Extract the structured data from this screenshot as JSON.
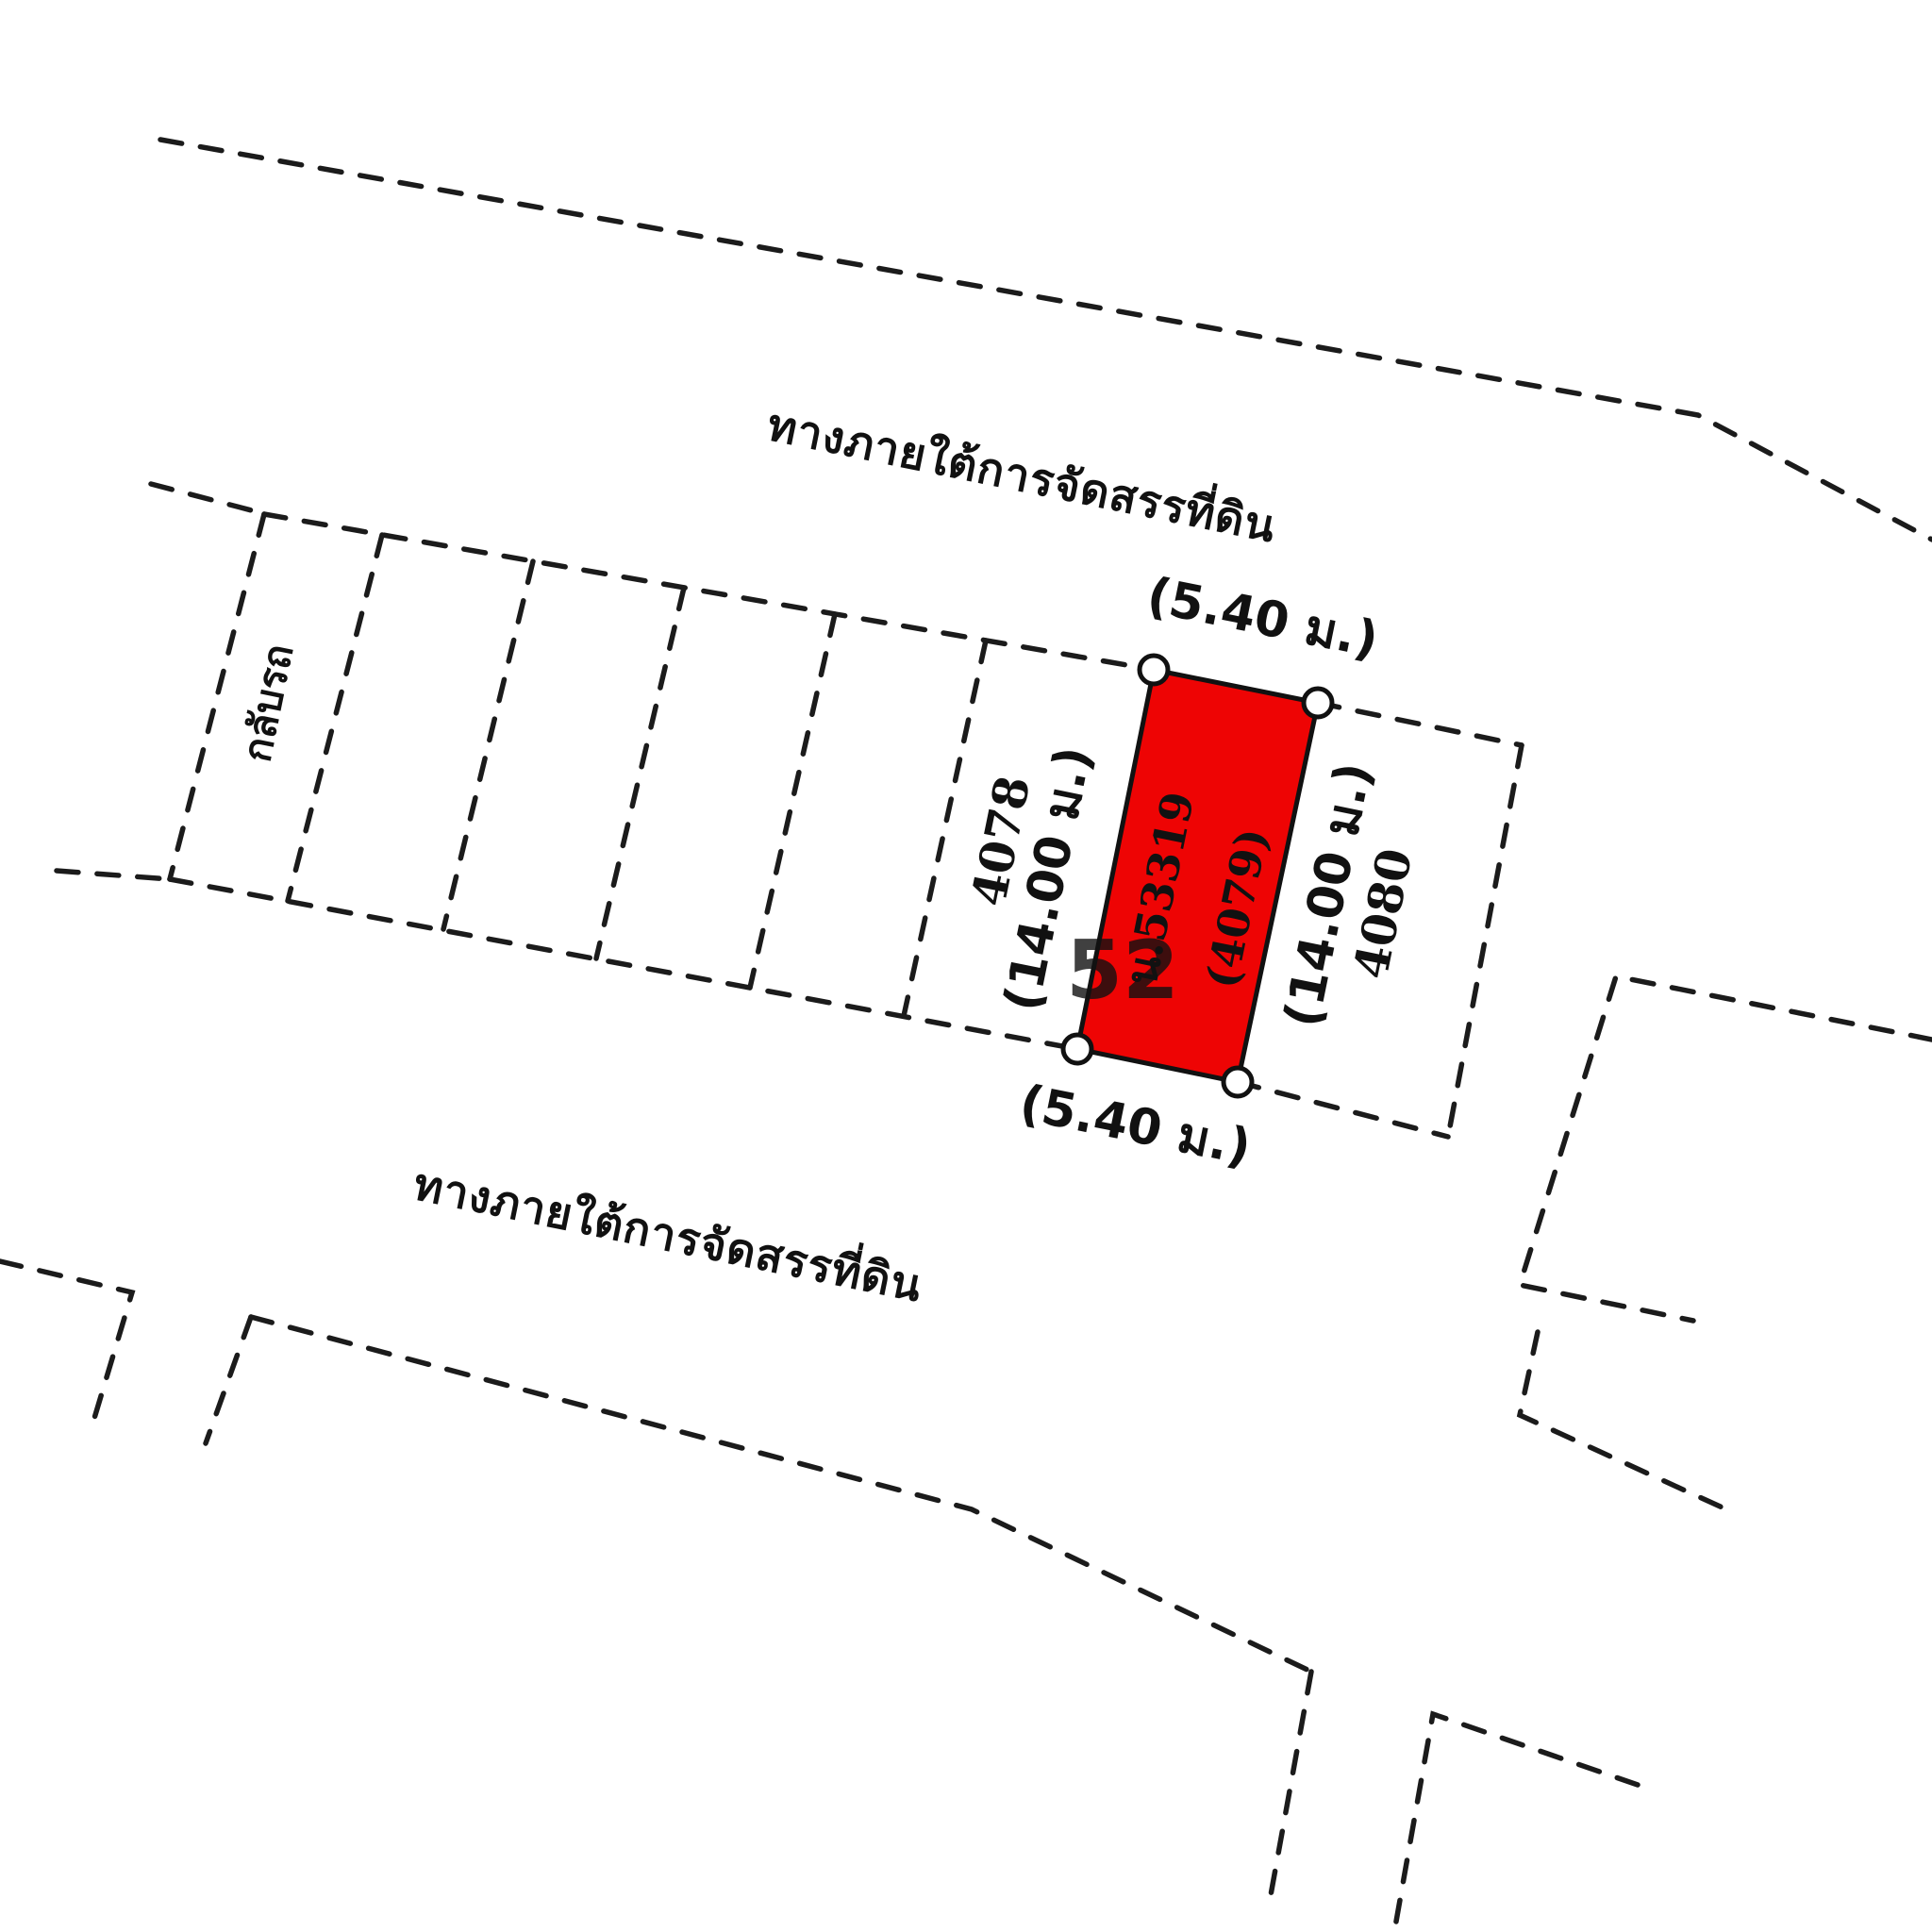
{
  "diagram": {
    "top_road_label": "ทางภายใต้การจัดสรรที่ดิน",
    "bottom_road_label": "ทางภายใต้การจัดสรรที่ดิน",
    "uturn_strip_label": "กลับรถ",
    "highlighted_plot": {
      "deed_no": "น.53319",
      "plot_no": "(4079)",
      "width_top": "(5.40 ม.)",
      "width_bottom": "(5.40 ม.)",
      "depth_left": "(14.00 ม.)",
      "depth_right": "(14.00 ม.)"
    },
    "left_plot_no": "4078",
    "right_plot_no": "4080",
    "watermark_text": "52",
    "colors": {
      "highlight_fill": "#ee0404",
      "dimension_text": "#cc0606",
      "line_color": "#1b1b1b",
      "background": "#ffffff",
      "watermark_color": "#ffd2d8"
    }
  }
}
